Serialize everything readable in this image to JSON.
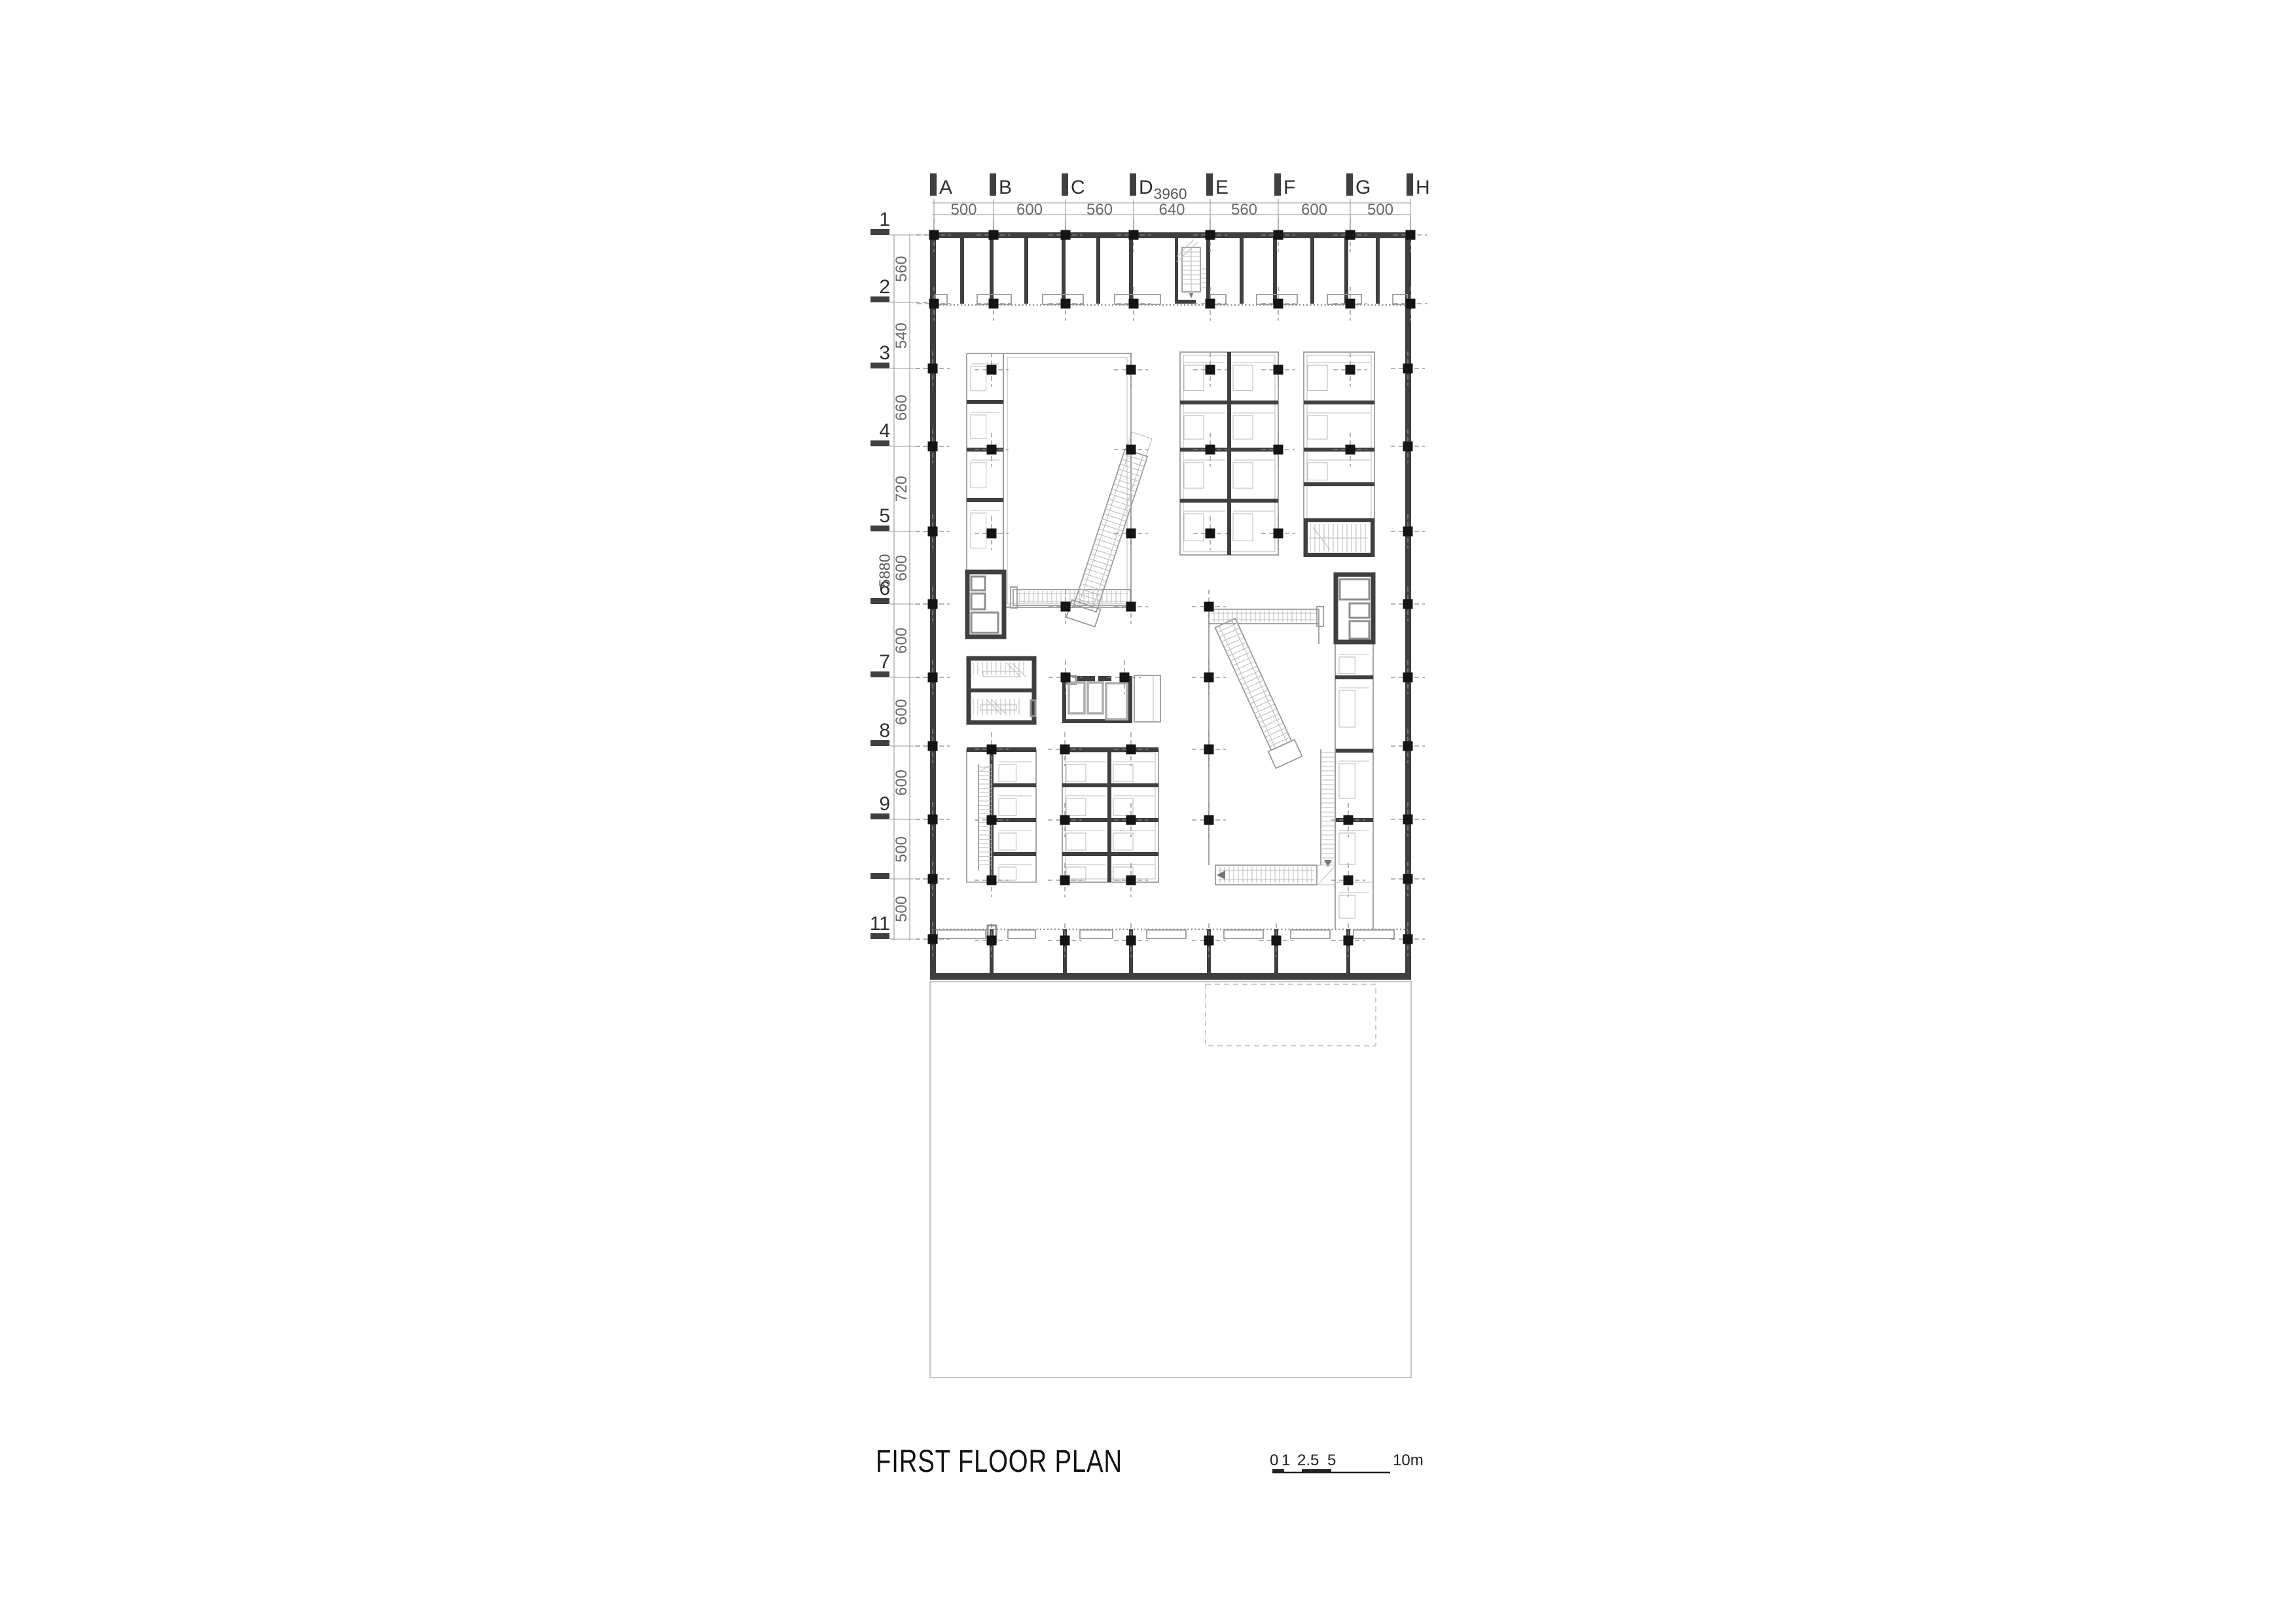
{
  "sheet": {
    "background": "#ffffff"
  },
  "title_block": {
    "title": "FIRST FLOOR PLAN"
  },
  "scale_bar": {
    "tick_labels": [
      "0",
      "1",
      "2.5",
      "5"
    ],
    "end_label": "10m"
  },
  "grid": {
    "overall_width_label": "3960",
    "overall_height_label": "5880",
    "columns": [
      {
        "label": "A"
      },
      {
        "label": "B"
      },
      {
        "label": "C"
      },
      {
        "label": "D"
      },
      {
        "label": "E"
      },
      {
        "label": "F"
      },
      {
        "label": "G"
      },
      {
        "label": "H"
      }
    ],
    "column_spacings": [
      "500",
      "600",
      "560",
      "640",
      "560",
      "600",
      "500"
    ],
    "rows": [
      {
        "label": "1"
      },
      {
        "label": "2"
      },
      {
        "label": "3"
      },
      {
        "label": "4"
      },
      {
        "label": "5"
      },
      {
        "label": "6"
      },
      {
        "label": "7"
      },
      {
        "label": "8"
      },
      {
        "label": "9"
      },
      {
        "label": ""
      },
      {
        "label": "11"
      }
    ],
    "row_spacings": [
      "560",
      "540",
      "660",
      "720",
      "600",
      "600",
      "600",
      "600",
      "500",
      "500"
    ]
  },
  "colors": {
    "background": "#ffffff",
    "wall": "#3f3f3f",
    "column": "#141414",
    "thin_line": "#9a9a9a",
    "faint_line": "#bdbdbd",
    "dashed_line": "#8a8a8a",
    "dim_text": "#6a6a6a",
    "label_text": "#2f2f2f",
    "title_text": "#141414"
  }
}
